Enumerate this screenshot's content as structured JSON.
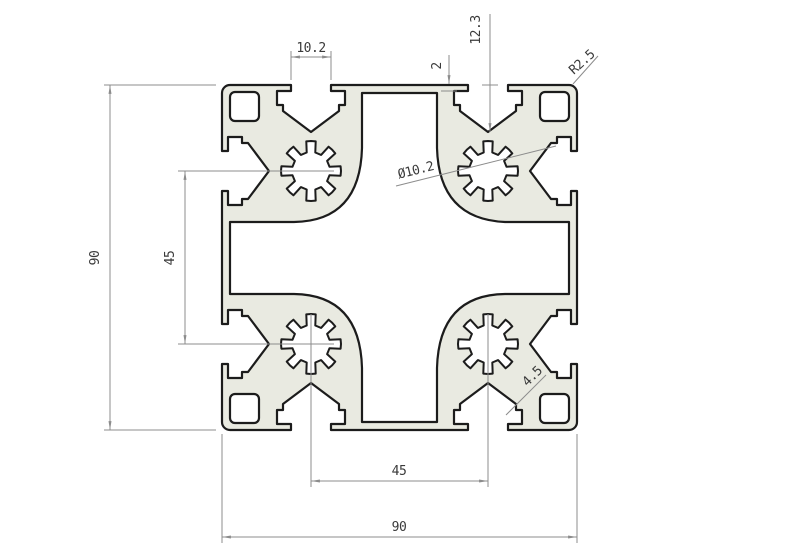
{
  "drawing": {
    "type": "technical-cross-section",
    "subject": "90x90 T-slot aluminium extrusion profile",
    "colors": {
      "background": "#ffffff",
      "profile_fill": "#e9eae1",
      "outline": "#1c1c1c",
      "dimension": "#8c8c8c",
      "text": "#3a3a3a"
    },
    "dimensions": {
      "slot_opening": "10.2",
      "lip_thickness": "2",
      "slot_depth": "12.3",
      "corner_radius": "R2.5",
      "core_hole": "Ø10.2",
      "height": "90",
      "slot_pitch_vertical": "45",
      "slot_pitch_horizontal": "45",
      "width": "90",
      "web_thickness": "4.5"
    }
  }
}
